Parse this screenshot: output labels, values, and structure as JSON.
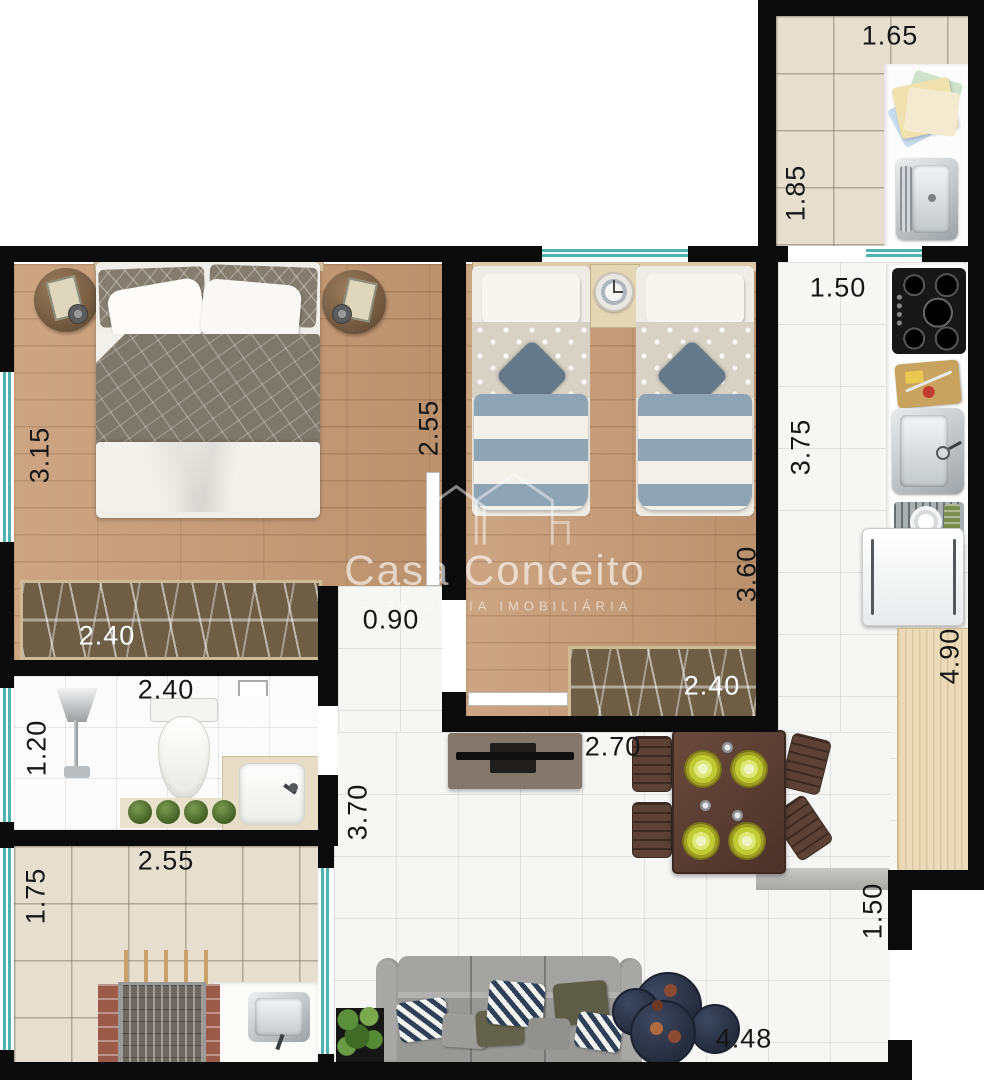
{
  "watermark": {
    "brand": "Casa Conceito",
    "tagline": "ASSESSORIA IMOBILIÁRIA"
  },
  "colors": {
    "wall": "#0b0b0b",
    "window": "#4fb3b1",
    "wood_floor": "#c79b75",
    "beige_tile": "#e6dfd0",
    "white_tile": "#f6f6f5",
    "counter_wood": "#ecdab8",
    "wardrobe": "#6e5e45",
    "dining_table": "#5a4238",
    "plate": "#c0ca33",
    "sofa": "#a0a0a0",
    "coffee_table": "#2c3344"
  },
  "labels": [
    {
      "id": "laundry-width",
      "text": "1.65"
    },
    {
      "id": "laundry-depth",
      "text": "1.85"
    },
    {
      "id": "kitchen-width",
      "text": "1.50"
    },
    {
      "id": "kitchen-depth",
      "text": "3.75"
    },
    {
      "id": "master-depth",
      "text": "3.15"
    },
    {
      "id": "master-width",
      "text": "2.55"
    },
    {
      "id": "master-wardrobe",
      "text": "2.40"
    },
    {
      "id": "bedroom2-depth",
      "text": "3.60"
    },
    {
      "id": "bedroom2-wardrobe",
      "text": "2.40"
    },
    {
      "id": "hallway-width",
      "text": "0.90"
    },
    {
      "id": "bathroom-width",
      "text": "2.40"
    },
    {
      "id": "bathroom-depth",
      "text": "1.20"
    },
    {
      "id": "balcony-width",
      "text": "2.55"
    },
    {
      "id": "balcony-depth",
      "text": "1.75"
    },
    {
      "id": "living-depth",
      "text": "3.70"
    },
    {
      "id": "tv-wall-width",
      "text": "2.70"
    },
    {
      "id": "counter-length",
      "text": "4.90"
    },
    {
      "id": "entry-width",
      "text": "1.50"
    },
    {
      "id": "living-width",
      "text": "4.48"
    }
  ]
}
